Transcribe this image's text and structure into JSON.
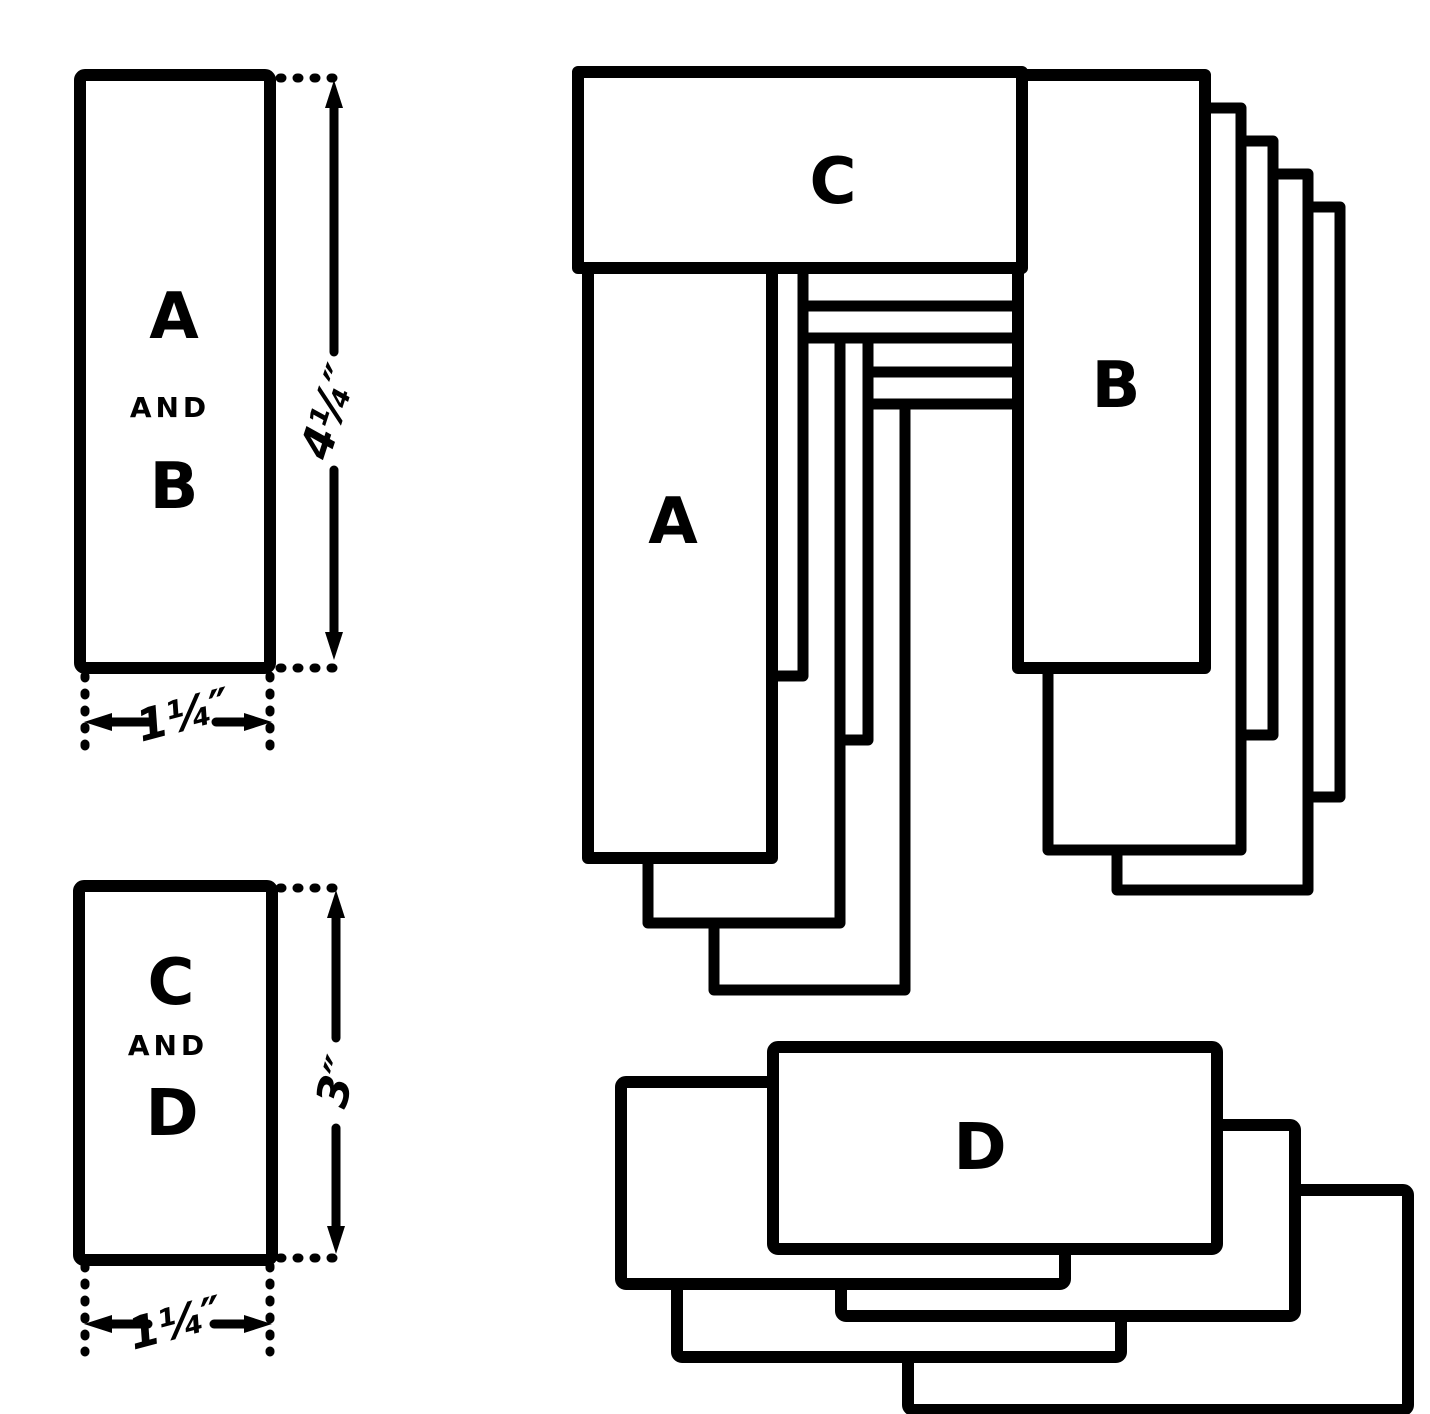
{
  "colors": {
    "ink": "#000000",
    "paper": "#ffffff"
  },
  "pattern_ab": {
    "letter_top": "A",
    "conjunction": "AND",
    "letter_bottom": "B",
    "length_label": "4¼″",
    "width_label": "1¼″"
  },
  "pattern_cd": {
    "letter_top": "C",
    "conjunction": "AND",
    "letter_bottom": "D",
    "length_label": "3″",
    "width_label": "1¼″"
  },
  "assembly": {
    "piece_a": "A",
    "piece_b": "B",
    "piece_c": "C"
  },
  "stack_d": {
    "piece_d": "D"
  }
}
